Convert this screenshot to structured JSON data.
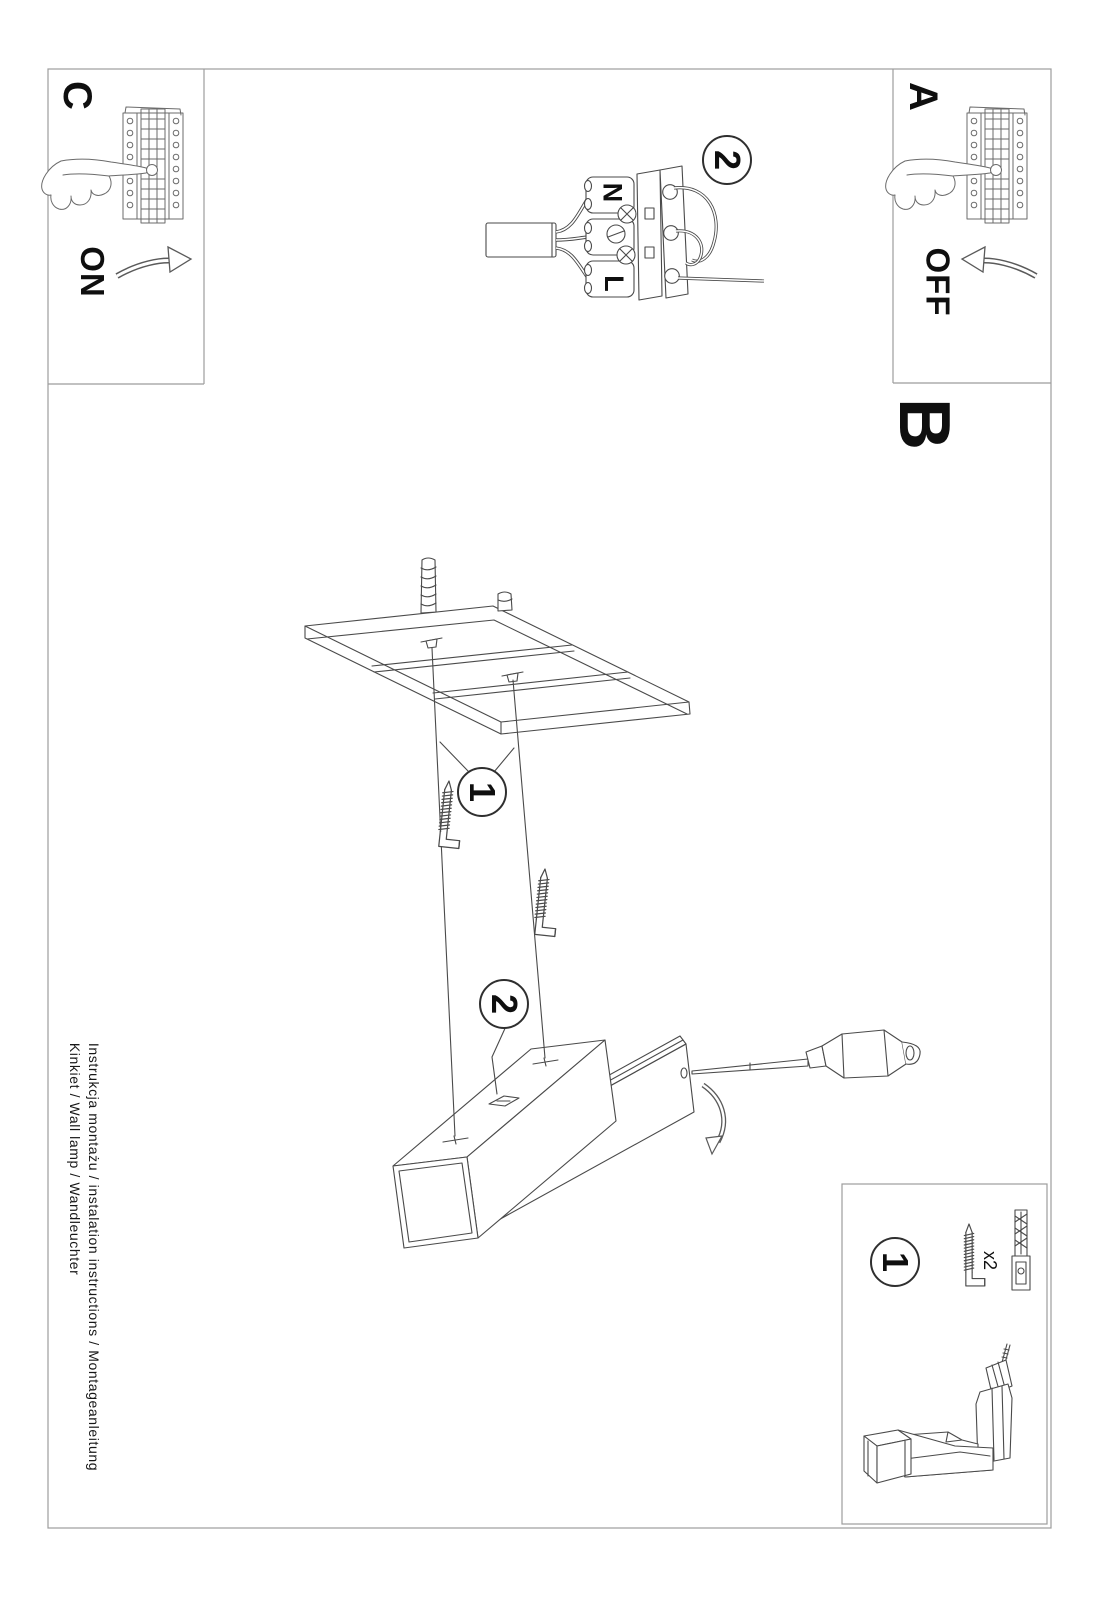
{
  "colors": {
    "background": "#ffffff",
    "ink": "#4a4a4a",
    "ink_light": "#6b6b6b",
    "panel_border": "#9c9c9c",
    "text": "#0f0f0f"
  },
  "sections": {
    "a": {
      "label": "A",
      "power_state": "OFF"
    },
    "b": {
      "label": "B"
    },
    "c": {
      "label": "C",
      "power_state": "ON"
    }
  },
  "wiring": {
    "badge": "2",
    "neutral_label": "N",
    "live_label": "L"
  },
  "mounting": {
    "anchors_badge": "1",
    "hang_badge": "2"
  },
  "tools_panel": {
    "badge": "1",
    "hardware_quantity": "x2"
  },
  "caption": {
    "line1": "Instrukcja montażu / instalation instructions / Montageanleitung",
    "line2": "Kinkiet / Wall lamp / Wandleuchter"
  },
  "icons": {
    "breaker_panel": "fuse-box with pointing hand",
    "rotate_arrow": "curved rotation arrow",
    "terminal_block": "3-pole screw terminal with N and L wires",
    "wall_plate": "wall boards with mounting screws",
    "hook_screw": "L-shaped hook screw",
    "wall_anchor": "expansion wall plug",
    "lamp_body": "linear wall lamp exploded view",
    "screwdriver": "screwdriver",
    "drill": "cordless drill"
  }
}
